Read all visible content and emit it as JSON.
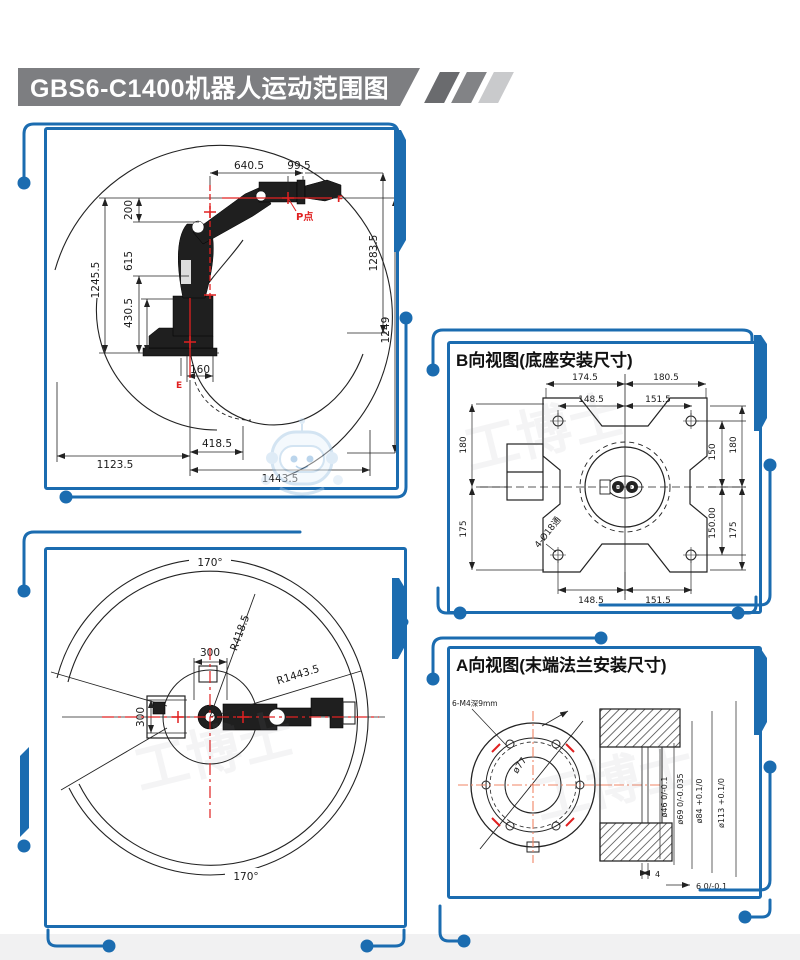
{
  "page": {
    "title": "GBS6-C1400机器人运动范围图"
  },
  "colors": {
    "frame_blue": "#1b6cb0",
    "banner_gray": "#7d7e81",
    "dim_red": "#e02020",
    "centerline_orange": "#f08465"
  },
  "watermark": {
    "text": "工博士"
  },
  "side_view": {
    "dims": {
      "d640": "640.5",
      "d99": "99.5",
      "d200": "200",
      "d615": "615",
      "d1245": "1245.5",
      "d430": "430.5",
      "d160": "160",
      "d1283": "1283.5",
      "d1249": "1249",
      "d1123": "1123.5",
      "d418": "418.5",
      "d1443": "1443.5"
    },
    "points": {
      "f": "F",
      "p": "P点",
      "e": "E"
    }
  },
  "top_view": {
    "dims": {
      "angle_top": "170°",
      "angle_bottom": "170°",
      "r_inner": "R418.5",
      "r_outer": "R1443.5",
      "w300": "300",
      "h300": "300"
    }
  },
  "b_view": {
    "title": "B向视图(底座安装尺寸)",
    "dims": {
      "top_left": "174.5",
      "top_right": "180.5",
      "mid_left": "148.5",
      "mid_right": "151.5",
      "bottom_left": "148.5",
      "bottom_right": "151.5",
      "left_top": "180",
      "left_bottom": "175",
      "right_inner_top": "150",
      "right_inner_bottom": "150.00",
      "right_outer_top": "180",
      "right_outer_bottom": "175",
      "holes_note": "4-Ø18通"
    }
  },
  "a_view": {
    "title": "A向视图(末端法兰安装尺寸)",
    "dims": {
      "bolt_note": "6-M4深9mm",
      "d77": "ø77",
      "d46": "ø46 0/-0.1",
      "d69": "ø69 0/-0.035",
      "d84": "ø84 +0.1/0",
      "d113": "ø113 +0.1/0",
      "depth4": "4",
      "step6": "6 0/-0.1"
    }
  }
}
